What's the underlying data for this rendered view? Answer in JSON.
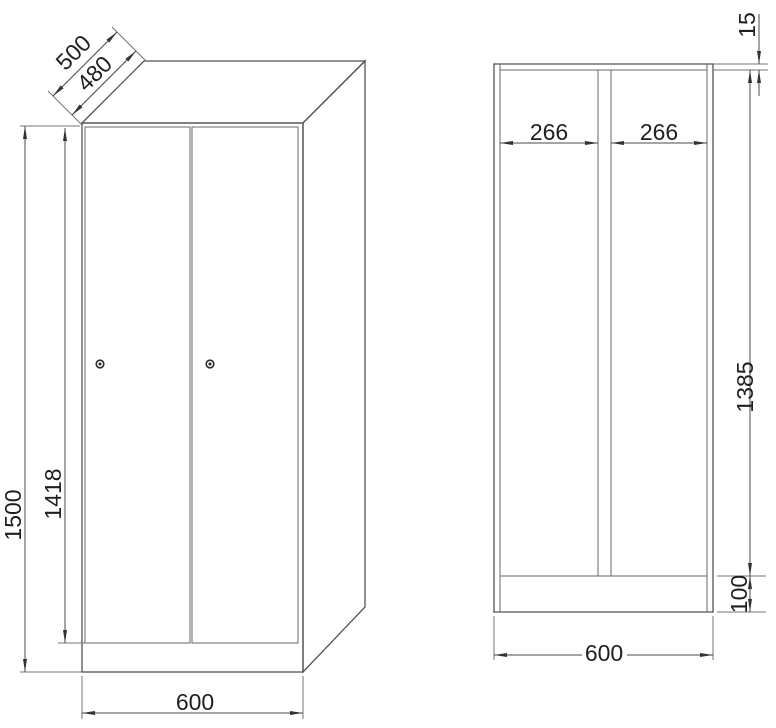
{
  "drawing": {
    "view_3d": {
      "depth_total_mm": "500",
      "depth_body_mm": "480",
      "height_total_mm": "1500",
      "door_height_mm": "1418",
      "width_mm": "600"
    },
    "view_section": {
      "top_panel_mm": "15",
      "left_compartment_width_mm": "266",
      "right_compartment_width_mm": "266",
      "inner_height_mm": "1385",
      "base_height_mm": "100",
      "width_mm": "600"
    }
  }
}
